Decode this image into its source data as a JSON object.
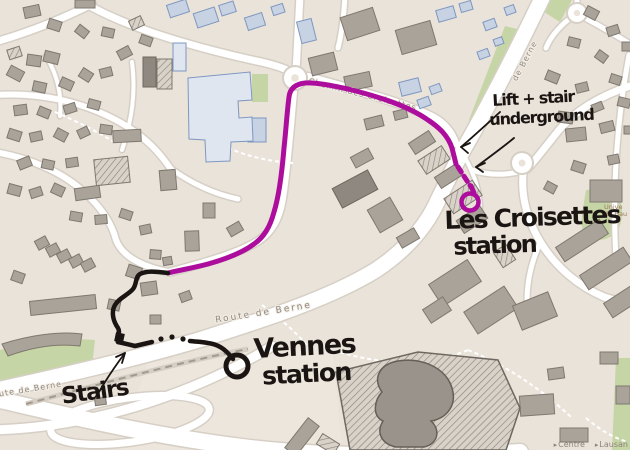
{
  "annotations": {
    "lift_stair": {
      "line1": "Lift + stair",
      "line2": "underground"
    },
    "les_croisettes_station": {
      "line1": "Les Croisettes",
      "line2": "station"
    },
    "vennes_station": {
      "line1": "Vennes",
      "line2": "station"
    },
    "stairs": {
      "label": "Stairs"
    }
  },
  "street_labels": [
    {
      "text": "Chemin des Croisettes",
      "x": 362,
      "y": 97,
      "rot": 14,
      "size": 8,
      "ls": 1,
      "color": "#8f877c"
    },
    {
      "text": "de Berne",
      "x": 527,
      "y": 62,
      "rot": -62,
      "size": 8,
      "ls": 1,
      "color": "#8f877c"
    },
    {
      "text": "Route de Berne",
      "x": 264,
      "y": 315,
      "rot": -9,
      "size": 9,
      "ls": 2,
      "color": "#8f877c"
    },
    {
      "text": "oute de Berne",
      "x": 28,
      "y": 392,
      "rot": -9,
      "size": 8,
      "ls": 1,
      "color": "#8f877c"
    }
  ],
  "poi_labels": [
    {
      "lines": [
        "Unive",
        "de Hau"
      ],
      "x": 604,
      "y": 209,
      "size": 6.5,
      "color": "#9b7c5c"
    }
  ],
  "signpost": {
    "items": [
      "Centre",
      "Lausan"
    ],
    "chevron": "▸"
  },
  "colors": {
    "bg": "#eae3da",
    "plaza": "#ece6dd",
    "road": "#ffffff",
    "casing": "#d6cfc5",
    "bldg_g": "#aaa39a",
    "bldg_g_stroke": "#7f786f",
    "bldg_d": "#8f8880",
    "bldg_b": "#c7d2e3",
    "bldg_b_stroke": "#7e97c0",
    "bldg_lb": "#e0e6ef",
    "hatch_base": "#d9d2c9",
    "hatch_line": "#8b847b",
    "green": "#c6d5a5",
    "magenta": "#ad0d9c",
    "ink": "#1a1512",
    "metro_base": "#d5cec4",
    "metro_dash": "#a29a8e"
  },
  "routes": {
    "magenta": {
      "solid_d": "M 456,164 L 452,148 C 448,136 440,128 428,120 C 408,106 380,97 348,89 C 330,85 314,82 305,83 C 296,84 290,88 289,97 C 287,112 286,130 284,148 C 282,172 279,196 274,212 C 270,227 264,237 254,244 C 242,253 226,259 208,264 C 193,268 180,270 168,273",
      "dash_d": "M 458,167 L 471,187",
      "stub_d": "M 471,186 L 474,193",
      "ring": {
        "cx": 470,
        "cy": 202,
        "r": 8.5
      }
    },
    "black": {
      "d1": "M 168,273 C 158,272 148,270 140,274 C 135,277 137,284 133,289 C 128,295 119,298 115,305 C 111,312 113,321 118,328 C 121,333 116,337 118,342",
      "d2": "M 118,342 L 135,346 L 152,342",
      "d3": "M 190,341 C 198,342 208,342 216,345 C 224,348 229,354 233,359",
      "dots": [
        [
          161,
          339
        ],
        [
          172,
          337
        ],
        [
          183,
          339
        ]
      ],
      "square": {
        "x": 115,
        "y": 333,
        "s": 9,
        "rot": 12
      },
      "ring": {
        "cx": 237,
        "cy": 366,
        "r": 11
      }
    }
  },
  "arrows": [
    {
      "d": "M 99,392 C 107,378 116,365 125,353",
      "h": "M 125,353 L 116,357 M 125,353 L 122,363"
    },
    {
      "d": "M 500,112 C 488,123 474,136 461,147",
      "h": "M 461,147 L 470,143 M 461,147 L 468,153"
    },
    {
      "d": "M 514,138 C 502,148 488,158 476,167",
      "h": "M 476,167 L 485,163 M 476,167 L 483,172"
    }
  ],
  "geometry": {
    "plaza": [
      "M 148,362 L 332,344 L 342,450 L 118,450 Z"
    ],
    "greens": [
      "M 505,26 L 521,30 L 490,118 L 474,133 L 469,120 Z",
      "M 252,74 L 268,74 L 268,102 L 252,102 Z",
      "M 586,190 Q 624,185 622,215 Q 620,242 592,240 Q 580,238 582,214 Z",
      "M 616,358 L 630,358 L 630,450 L 612,450 Z",
      "M 0,350 Q 50,336 95,340 L 92,366 Q 45,372 0,388 Z",
      "M 548,0 L 572,0 L 560,22 L 544,12 Z"
    ],
    "roads": [
      {
        "d": "M 545,-8 C 522,40 497,90 470,138 C 456,162 448,180 439,198 C 427,226 406,250 376,270 C 332,297 272,317 202,339 C 142,357 70,374 -8,391",
        "w": 15
      },
      {
        "d": "M -8,398 C 60,414 150,436 250,448 C 330,457 420,458 520,452",
        "w": 16
      },
      {
        "d": "M -8,430 C 70,428 150,408 225,372 C 245,362 260,354 272,346",
        "w": 9
      },
      {
        "d": "M 308,77 C 348,88 402,102 432,117 C 444,123 451,132 455,143",
        "w": 8
      },
      {
        "d": "M 294,86 C 291,120 288,160 283,195 C 280,218 272,232 258,241 C 240,252 215,260 170,272",
        "w": 7
      },
      {
        "d": "M 90,6 C 130,28 190,46 252,60 C 272,64 284,68 291,72",
        "w": 7
      },
      {
        "d": "M -5,42 C 30,32 60,20 92,4",
        "w": 7
      },
      {
        "d": "M -5,95 C 40,92 80,102 112,118 C 140,132 158,150 170,168",
        "w": 6
      },
      {
        "d": "M -5,152 C 30,158 62,172 84,192 C 102,208 112,224 116,240 C 122,256 140,266 168,272",
        "w": 6
      },
      {
        "d": "M 46,56 C 58,76 62,96 60,116",
        "w": 4
      },
      {
        "d": "M 132,62 C 136,92 132,120 122,150",
        "w": 4
      },
      {
        "d": "M 170,168 C 192,184 214,194 238,199",
        "w": 5
      },
      {
        "d": "M 296,72 L 300,-5",
        "w": 7
      },
      {
        "d": "M 345,-5 C 344,15 342,32 338,48",
        "w": 5
      },
      {
        "d": "M 630,86 C 600,96 576,110 559,130 C 543,150 534,162 527,169",
        "w": 7
      },
      {
        "d": "M 523,174 C 521,198 528,222 541,243 C 556,267 578,286 604,297 C 613,300 622,302 632,303",
        "w": 7
      },
      {
        "d": "M 629,55 C 617,120 612,190 616,260",
        "w": 5
      },
      {
        "d": "M 472,170 C 490,176 508,175 522,171",
        "w": 5
      },
      {
        "d": "M 455,143 C 462,152 468,162 472,172 C 478,186 480,198 480,210",
        "w": 4
      },
      {
        "d": "M 540,243 C 530,265 525,290 528,315",
        "w": 5
      },
      {
        "d": "M 577,-4 L 577,6",
        "w": 5
      },
      {
        "d": "M 585,18 C 600,26 614,34 630,44",
        "w": 5
      },
      {
        "d": "M 569,19 C 558,28 550,38 546,48",
        "w": 5
      }
    ],
    "loop": {
      "cx": 130,
      "cy": 420,
      "rx": 80,
      "ry": 22,
      "rot": -8,
      "w": 7
    },
    "roundabouts": [
      {
        "cx": 295,
        "cy": 78,
        "r": 11
      },
      {
        "cx": 522,
        "cy": 163,
        "r": 10
      },
      {
        "cx": 577,
        "cy": 13,
        "r": 9
      }
    ],
    "metro": {
      "d": "M 26,404 C 100,384 180,362 248,349"
    },
    "footpaths": [
      "M 340,352 C 390,368 440,362 468,350",
      "M 468,350 C 508,366 545,392 572,418",
      "M 262,305 C 285,322 302,338 312,352",
      "M 55,112 C 78,122 98,132 114,142",
      "M 228,148 C 252,158 274,162 294,163",
      "M 586,418 C 600,430 614,438 628,442"
    ],
    "buildings": [
      [
        24,
        6,
        16,
        11,
        -12,
        "g"
      ],
      [
        75,
        0,
        20,
        8,
        0,
        "g"
      ],
      [
        48,
        20,
        13,
        10,
        18,
        "g"
      ],
      [
        76,
        27,
        12,
        9,
        38,
        "g"
      ],
      [
        102,
        28,
        12,
        9,
        12,
        "g"
      ],
      [
        130,
        18,
        13,
        10,
        -25,
        "h"
      ],
      [
        8,
        48,
        13,
        10,
        -18,
        "h"
      ],
      [
        27,
        55,
        14,
        11,
        8,
        "g"
      ],
      [
        44,
        52,
        15,
        11,
        14,
        "g"
      ],
      [
        118,
        48,
        13,
        10,
        -28,
        "g"
      ],
      [
        140,
        36,
        12,
        9,
        20,
        "g"
      ],
      [
        8,
        68,
        15,
        11,
        28,
        "g"
      ],
      [
        33,
        82,
        13,
        10,
        12,
        "g"
      ],
      [
        60,
        79,
        13,
        10,
        24,
        "g"
      ],
      [
        80,
        70,
        12,
        10,
        33,
        "g"
      ],
      [
        100,
        68,
        12,
        9,
        -14,
        "g"
      ],
      [
        14,
        105,
        13,
        10,
        -8,
        "g"
      ],
      [
        38,
        108,
        12,
        9,
        22,
        "g"
      ],
      [
        64,
        104,
        12,
        9,
        -18,
        "g"
      ],
      [
        88,
        100,
        12,
        9,
        15,
        "g"
      ],
      [
        8,
        130,
        13,
        10,
        18,
        "g"
      ],
      [
        30,
        132,
        12,
        9,
        -12,
        "g"
      ],
      [
        55,
        130,
        12,
        10,
        28,
        "g"
      ],
      [
        78,
        128,
        11,
        9,
        -25,
        "g"
      ],
      [
        100,
        125,
        12,
        9,
        8,
        "g"
      ],
      [
        18,
        158,
        13,
        10,
        -22,
        "g"
      ],
      [
        42,
        160,
        12,
        9,
        12,
        "g"
      ],
      [
        66,
        158,
        12,
        9,
        -8,
        "g"
      ],
      [
        8,
        185,
        13,
        10,
        15,
        "g"
      ],
      [
        30,
        188,
        12,
        9,
        -18,
        "g"
      ],
      [
        52,
        185,
        12,
        10,
        25,
        "g"
      ],
      [
        70,
        212,
        12,
        9,
        10,
        "g"
      ],
      [
        95,
        215,
        12,
        9,
        -5,
        "g"
      ],
      [
        120,
        210,
        12,
        9,
        18,
        "g"
      ],
      [
        140,
        225,
        11,
        9,
        -12,
        "g"
      ],
      [
        36,
        238,
        12,
        10,
        -28,
        "g"
      ],
      [
        47,
        245,
        12,
        10,
        -28,
        "g"
      ],
      [
        58,
        251,
        12,
        10,
        -28,
        "g"
      ],
      [
        70,
        256,
        12,
        10,
        -28,
        "g"
      ],
      [
        82,
        260,
        12,
        10,
        -28,
        "g"
      ],
      [
        30,
        298,
        66,
        14,
        -6,
        "g"
      ],
      [
        12,
        272,
        12,
        10,
        20,
        "g"
      ],
      [
        95,
        398,
        11,
        7,
        -8,
        "g"
      ],
      [
        143,
        57,
        13,
        30,
        0,
        "d"
      ],
      [
        157,
        59,
        15,
        30,
        0,
        "h"
      ],
      [
        113,
        130,
        28,
        12,
        -3,
        "g"
      ],
      [
        160,
        170,
        16,
        20,
        -5,
        "g"
      ],
      [
        95,
        158,
        34,
        26,
        -6,
        "h"
      ],
      [
        75,
        187,
        25,
        12,
        -8,
        "g"
      ],
      [
        203,
        203,
        12,
        15,
        0,
        "g"
      ],
      [
        228,
        224,
        14,
        10,
        -30,
        "g"
      ],
      [
        185,
        231,
        14,
        20,
        -2,
        "g"
      ],
      [
        150,
        250,
        11,
        9,
        5,
        "g"
      ],
      [
        163,
        257,
        9,
        8,
        -10,
        "g"
      ],
      [
        127,
        266,
        14,
        12,
        18,
        "g"
      ],
      [
        141,
        282,
        16,
        13,
        -8,
        "g"
      ],
      [
        108,
        300,
        12,
        10,
        12,
        "g"
      ],
      [
        150,
        315,
        11,
        9,
        0,
        "g"
      ],
      [
        180,
        292,
        11,
        9,
        -20,
        "g"
      ],
      [
        168,
        2,
        20,
        13,
        -18,
        "b"
      ],
      [
        195,
        10,
        22,
        15,
        -18,
        "b"
      ],
      [
        220,
        3,
        15,
        11,
        -18,
        "b"
      ],
      [
        246,
        15,
        18,
        13,
        -18,
        "b"
      ],
      [
        272,
        5,
        12,
        9,
        -18,
        "b"
      ],
      [
        299,
        20,
        15,
        22,
        -14,
        "b"
      ],
      [
        173,
        43,
        13,
        28,
        0,
        "lb"
      ],
      [
        193,
        82,
        14,
        16,
        0,
        "b"
      ],
      [
        226,
        76,
        16,
        22,
        0,
        "b"
      ],
      [
        248,
        118,
        18,
        24,
        0,
        "b"
      ],
      [
        343,
        12,
        34,
        24,
        -18,
        "g"
      ],
      [
        310,
        55,
        26,
        18,
        -14,
        "g"
      ],
      [
        345,
        74,
        26,
        15,
        -12,
        "g"
      ],
      [
        400,
        80,
        20,
        14,
        -14,
        "b"
      ],
      [
        365,
        117,
        18,
        11,
        -14,
        "g"
      ],
      [
        394,
        110,
        13,
        9,
        -14,
        "g"
      ],
      [
        398,
        25,
        36,
        25,
        -16,
        "g"
      ],
      [
        437,
        8,
        18,
        12,
        -16,
        "b"
      ],
      [
        460,
        2,
        12,
        9,
        -16,
        "b"
      ],
      [
        478,
        50,
        11,
        8,
        -20,
        "b"
      ],
      [
        494,
        38,
        9,
        7,
        -20,
        "b"
      ],
      [
        484,
        20,
        12,
        9,
        -20,
        "b"
      ],
      [
        505,
        6,
        10,
        8,
        -20,
        "b"
      ],
      [
        418,
        98,
        12,
        9,
        -20,
        "b"
      ],
      [
        430,
        85,
        11,
        8,
        -20,
        "b"
      ],
      [
        410,
        136,
        24,
        13,
        -33,
        "g"
      ],
      [
        420,
        152,
        28,
        16,
        -33,
        "h"
      ],
      [
        436,
        170,
        24,
        13,
        -33,
        "g"
      ],
      [
        446,
        188,
        34,
        18,
        -33,
        "h"
      ],
      [
        458,
        212,
        28,
        15,
        -33,
        "g"
      ],
      [
        335,
        178,
        40,
        22,
        -28,
        "d"
      ],
      [
        372,
        202,
        26,
        26,
        -30,
        "g"
      ],
      [
        398,
        232,
        20,
        12,
        -30,
        "g"
      ],
      [
        352,
        152,
        20,
        12,
        -28,
        "g"
      ],
      [
        432,
        270,
        46,
        26,
        -33,
        "g"
      ],
      [
        467,
        297,
        48,
        26,
        -33,
        "g"
      ],
      [
        425,
        302,
        24,
        16,
        -33,
        "g"
      ],
      [
        497,
        247,
        15,
        18,
        -33,
        "h"
      ],
      [
        516,
        298,
        38,
        26,
        -22,
        "g"
      ],
      [
        556,
        232,
        52,
        17,
        -33,
        "g"
      ],
      [
        580,
        260,
        52,
        17,
        -33,
        "g"
      ],
      [
        604,
        288,
        52,
        17,
        -33,
        "g"
      ],
      [
        585,
        8,
        13,
        10,
        28,
        "g"
      ],
      [
        607,
        26,
        12,
        9,
        -18,
        "g"
      ],
      [
        568,
        38,
        12,
        9,
        14,
        "g"
      ],
      [
        596,
        52,
        11,
        9,
        36,
        "g"
      ],
      [
        622,
        42,
        11,
        9,
        0,
        "g"
      ],
      [
        546,
        72,
        13,
        10,
        22,
        "g"
      ],
      [
        576,
        83,
        12,
        9,
        -14,
        "g"
      ],
      [
        610,
        75,
        11,
        9,
        18,
        "g"
      ],
      [
        558,
        112,
        15,
        11,
        8,
        "g"
      ],
      [
        592,
        103,
        11,
        8,
        -22,
        "g"
      ],
      [
        618,
        98,
        12,
        9,
        14,
        "g"
      ],
      [
        566,
        128,
        20,
        13,
        -6,
        "g"
      ],
      [
        600,
        122,
        14,
        10,
        -14,
        "g"
      ],
      [
        624,
        126,
        10,
        8,
        0,
        "g"
      ],
      [
        572,
        162,
        13,
        10,
        18,
        "g"
      ],
      [
        608,
        155,
        11,
        9,
        -12,
        "g"
      ],
      [
        590,
        180,
        32,
        22,
        0,
        "g"
      ],
      [
        545,
        183,
        11,
        9,
        28,
        "g"
      ],
      [
        548,
        368,
        16,
        11,
        -8,
        "g"
      ],
      [
        520,
        395,
        34,
        20,
        -4,
        "g"
      ],
      [
        560,
        428,
        28,
        14,
        0,
        "g"
      ],
      [
        600,
        352,
        18,
        12,
        0,
        "g"
      ],
      [
        616,
        386,
        14,
        18,
        0,
        "g"
      ],
      [
        295,
        418,
        14,
        38,
        38,
        "g"
      ],
      [
        318,
        438,
        20,
        12,
        32,
        "h"
      ],
      [
        452,
        428,
        42,
        16,
        -4,
        "g"
      ]
    ],
    "special": [
      {
        "d": "M 188,78 L 250,72 L 252,100 L 238,101 L 239,118 L 252,117 L 253,141 L 231,142 L 230,161 L 206,162 L 205,140 L 189,139 Z",
        "type": "lb"
      },
      {
        "d": "M 2,344 C 30,335 60,331 82,334 L 80,346 C 55,343 30,348 8,356 Z",
        "type": "g"
      },
      {
        "d": "M 336,372 L 418,352 L 498,360 L 520,408 L 506,450 L 350,450 Z",
        "type": "complex"
      },
      {
        "d": "M 382,392 C 372,378 380,364 398,361 C 422,357 446,368 452,388 C 457,404 448,418 431,421 C 441,430 438,444 424,447 L 396,447 C 381,444 376,432 383,421 C 372,416 374,400 382,392 Z",
        "type": "blob"
      }
    ]
  }
}
